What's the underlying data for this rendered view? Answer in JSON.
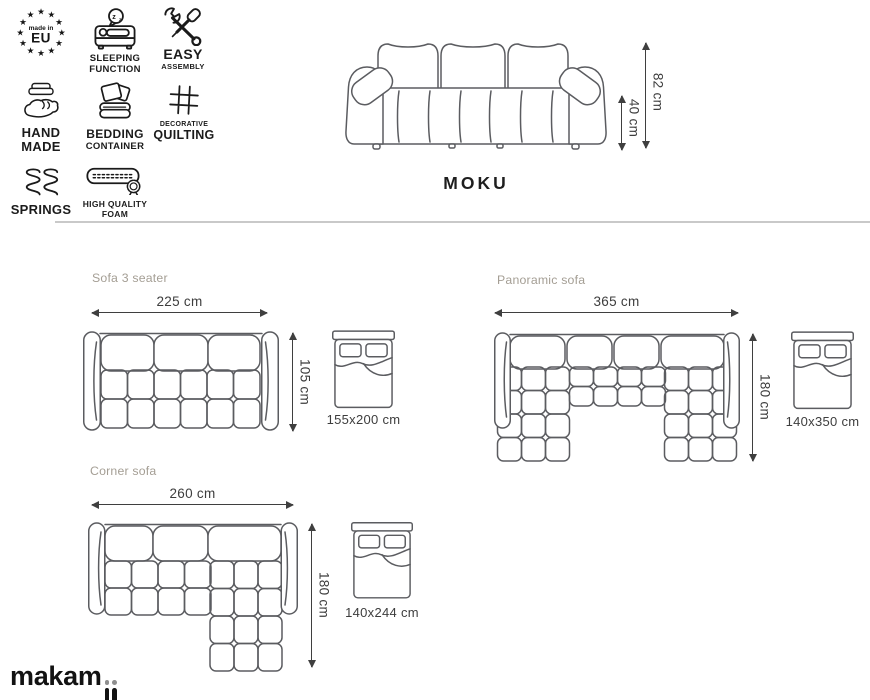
{
  "colors": {
    "ink": "#1a1a1a",
    "drawing_line": "#5b5c60",
    "dimension_text": "#3d3d3d",
    "section_title": "#a49e94",
    "divider": "#c9c9c9",
    "logo_dot": "#8f8f8f"
  },
  "features": [
    {
      "icon": "made-in-eu-stars",
      "line1": "made in",
      "line2": "EU"
    },
    {
      "icon": "sleeping-function",
      "line1": "SLEEPING",
      "line2": "FUNCTION"
    },
    {
      "icon": "easy-assembly",
      "line1": "EASY",
      "line2": "ASSEMBLY"
    },
    {
      "icon": "hand-made",
      "line1": "HAND",
      "line2": "MADE"
    },
    {
      "icon": "bedding-container",
      "line1": "BEDDING",
      "line2": "CONTAINER"
    },
    {
      "icon": "decorative-quilting",
      "line1": "DECORATIVE",
      "line2": "QUILTING"
    },
    {
      "icon": "springs",
      "line1": "SPRINGS",
      "line2": ""
    },
    {
      "icon": "high-quality-foam",
      "line1": "HIGH QUALITY",
      "line2": "FOAM"
    }
  ],
  "product": {
    "name": "MOKU",
    "total_height": "82 cm",
    "seat_height": "40 cm"
  },
  "variants": [
    {
      "title": "Sofa 3 seater",
      "width": "225 cm",
      "depth": "105 cm",
      "bed_size": "155x200 cm"
    },
    {
      "title": "Panoramic sofa",
      "width": "365 cm",
      "depth": "180 cm",
      "bed_size": "140x350 cm"
    },
    {
      "title": "Corner sofa",
      "width": "260 cm",
      "depth": "180 cm",
      "bed_size": "140x244 cm"
    }
  ],
  "brand": {
    "logo": "makamii",
    "logo_prefix": "makam"
  }
}
